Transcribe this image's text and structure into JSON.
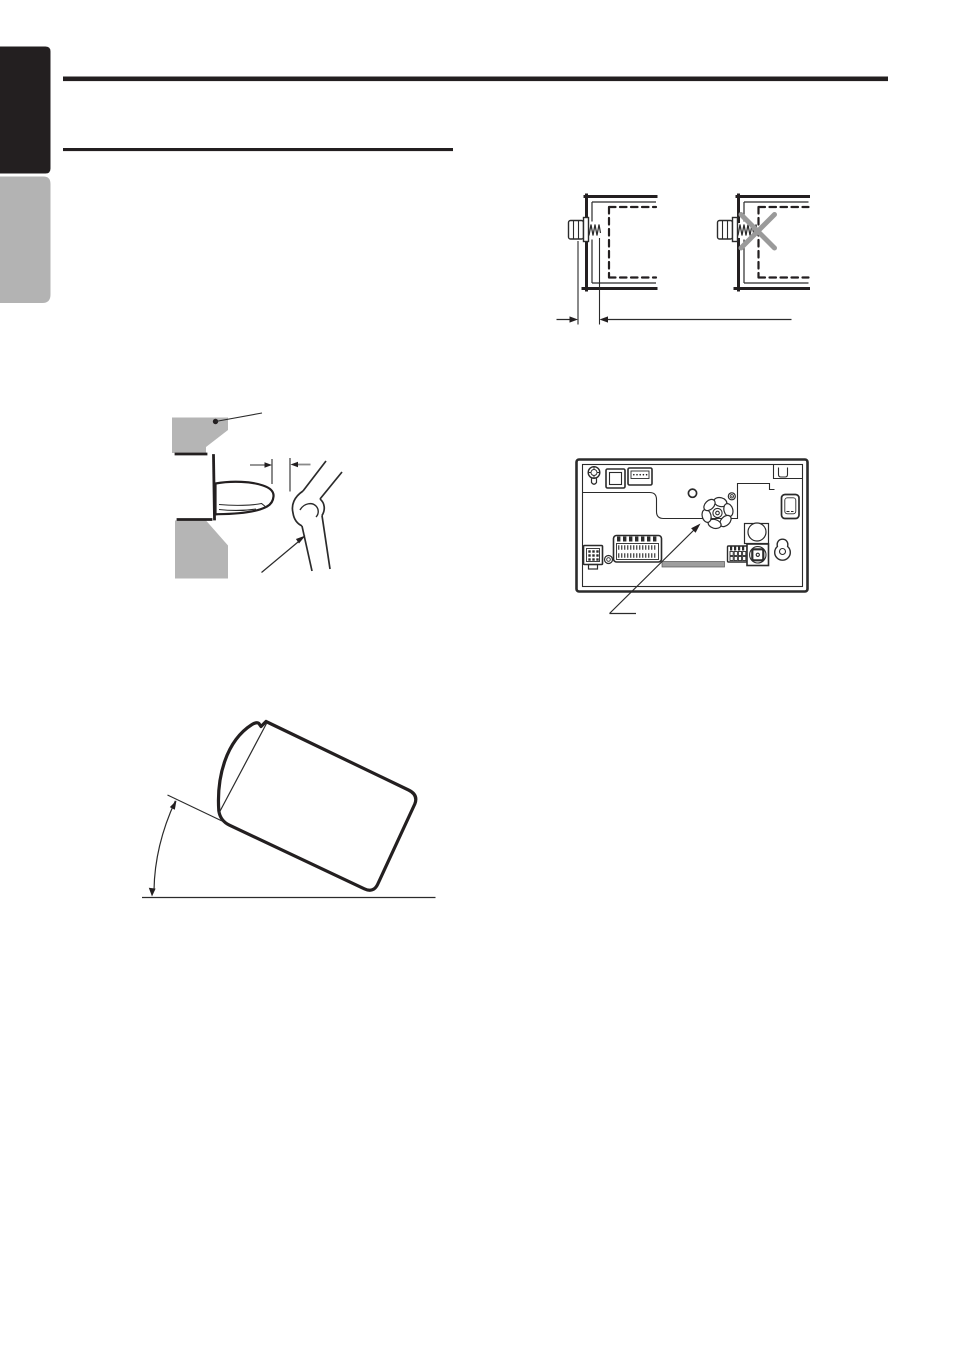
{
  "page": {
    "width": 954,
    "height": 1351,
    "background": "#ffffff"
  },
  "colors": {
    "ink": "#231f20",
    "diagram_line": "#2b2b2b",
    "tab_black": "#231f20",
    "tab_gray": "#b3b3b3",
    "panel_gray": "#b5b5b5",
    "cross_gray": "#9a9a9a",
    "dim_arrow_gray": "#8a8a8a",
    "vent_gray": "#9e9e9e"
  },
  "chrome": {
    "edge_tabs": [
      {
        "name": "edge-tab-upper",
        "color_ref": "tab_black"
      },
      {
        "name": "edge-tab-lower",
        "color_ref": "tab_gray"
      }
    ],
    "rules": [
      {
        "name": "header-rule"
      },
      {
        "name": "section-title-rule"
      }
    ]
  },
  "figures": [
    {
      "name": "screw-length-figure"
    },
    {
      "name": "panel-gap-figure"
    },
    {
      "name": "rear-panel-figure"
    },
    {
      "name": "mounting-angle-figure"
    }
  ]
}
